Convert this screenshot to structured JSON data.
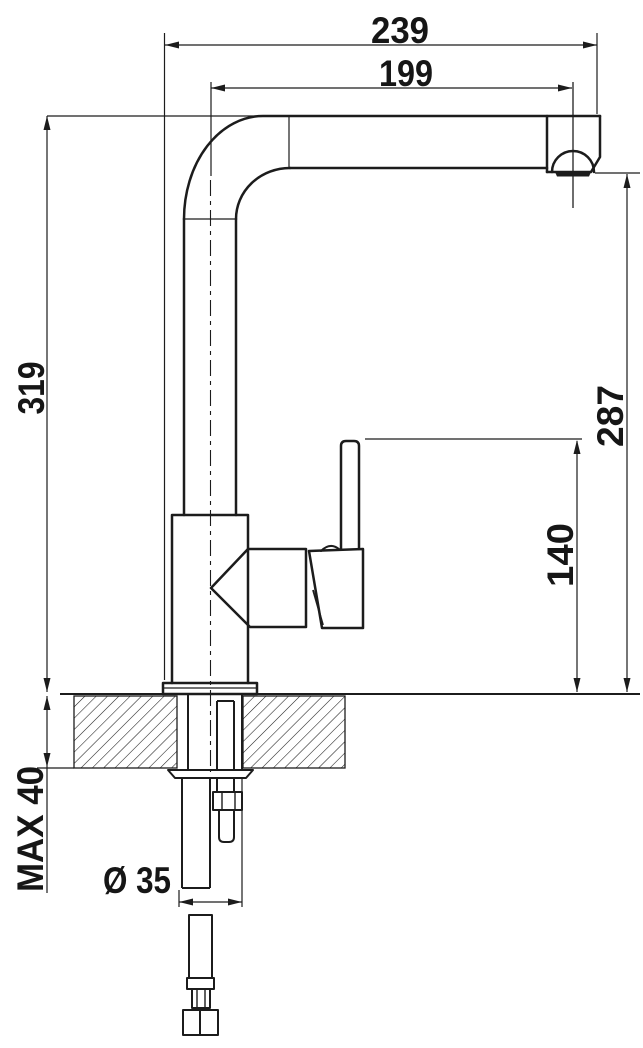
{
  "drawing": {
    "type": "faucet installation dimension drawing",
    "colors": {
      "line": "#1c1c1c",
      "background": "#ffffff"
    },
    "dims": {
      "total_reach": {
        "label": "239"
      },
      "spout_reach": {
        "label": "199"
      },
      "total_height": {
        "label": "319"
      },
      "outlet_height": {
        "label": "287"
      },
      "handle_height": {
        "label": "140"
      },
      "counter_thickness": {
        "label": "MAX 40"
      },
      "hole_diameter": {
        "label": "Ø 35"
      }
    }
  }
}
